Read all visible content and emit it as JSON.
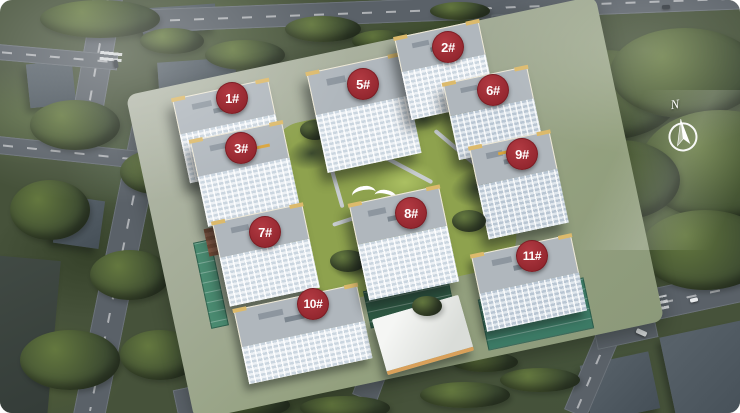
{
  "badges": [
    {
      "building": "1",
      "label": "1#"
    },
    {
      "building": "2",
      "label": "2#"
    },
    {
      "building": "3",
      "label": "3#"
    },
    {
      "building": "5",
      "label": "5#"
    },
    {
      "building": "6",
      "label": "6#"
    },
    {
      "building": "7",
      "label": "7#"
    },
    {
      "building": "8",
      "label": "8#"
    },
    {
      "building": "9",
      "label": "9#"
    },
    {
      "building": "10",
      "label": "10#"
    },
    {
      "building": "11",
      "label": "11#"
    }
  ],
  "compass": {
    "label": "N"
  },
  "colors": {
    "badge_red": "#a02c34",
    "badge_text": "#ffffff",
    "road_gray": "#5a6168",
    "tree_dark": "#36422a",
    "tree_light": "#64783f",
    "lawn_green": "#9db457",
    "building_light": "#edf1f5",
    "building_shade": "#b9c6d3",
    "roof_gray": "#b0b7bd",
    "parapet_yellow": "#dcba6c",
    "teal_roof": "#3c7a65",
    "compass_white": "#ffffff"
  }
}
